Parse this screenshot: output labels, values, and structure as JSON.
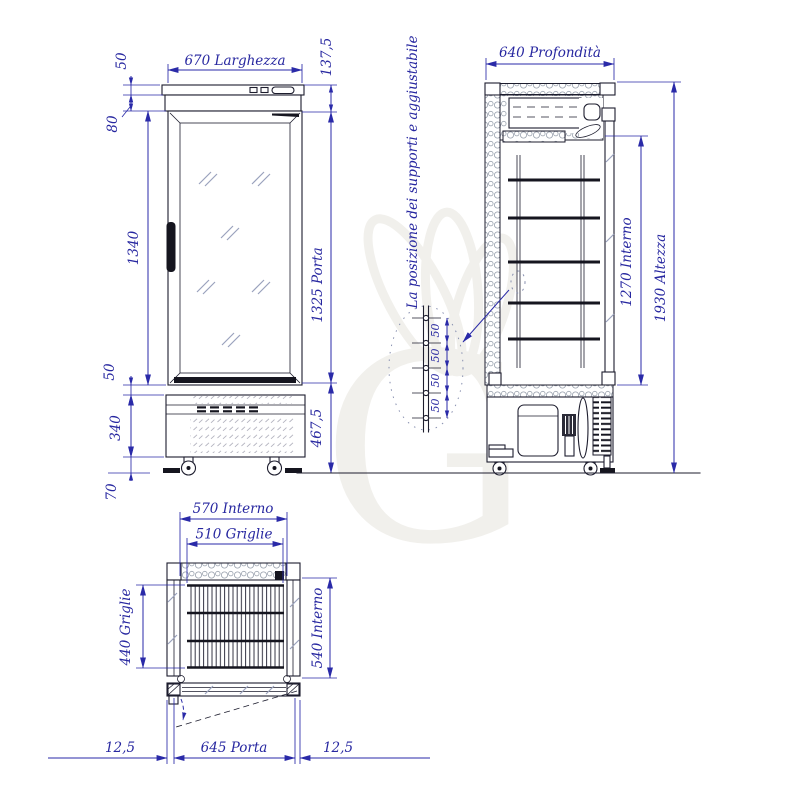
{
  "drawing": {
    "colors": {
      "dimension_blue": "#2a2aa8",
      "text_blue": "#2727a0",
      "line_dark": "#1d1d2e",
      "watermark_gray": "#f1f0ec"
    },
    "watermark_letter": "G",
    "front_view": {
      "dims": {
        "canopy_height": "50",
        "width": "670 Larghezza",
        "header_total": "137,5",
        "header_band": "80",
        "glass_height": "1340",
        "door_height": "1325 Porta",
        "sill": "50",
        "base_height": "340",
        "base_total": "467,5",
        "floor_clearance": "70"
      }
    },
    "side_view": {
      "dims": {
        "depth": "640 Profondità",
        "interior_height": "1270 Interno",
        "total_height": "1930 Altezza"
      }
    },
    "plan_view": {
      "dims": {
        "interior_width": "570 Interno",
        "shelf_width": "510 Griglie",
        "shelf_depth": "440 Griglie",
        "interior_depth": "540 Interno",
        "door_width": "645 Porta",
        "left_gap": "12,5",
        "right_gap": "12,5"
      }
    },
    "detail": {
      "note": "La posizione dei supporti e aggiustabile",
      "spacings": [
        "50",
        "50",
        "50",
        "50"
      ]
    }
  }
}
